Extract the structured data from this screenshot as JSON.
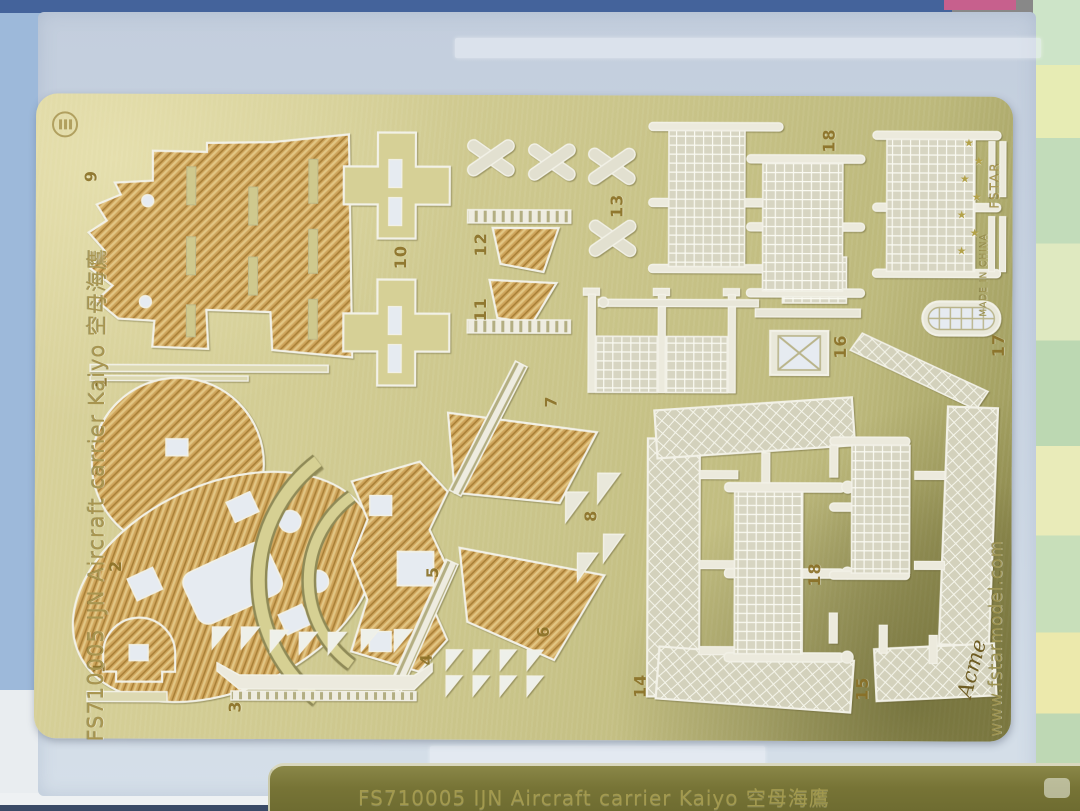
{
  "fret": {
    "title_text": "FS710005 IJN Aircraft carrier Kaiyo 空母海鷹",
    "brand_url": "www.fstarmodel.com",
    "made_in": "MADE IN CHINA",
    "brand": "FSTAR",
    "star": "★",
    "signature": "Acme",
    "part_labels": [
      "9",
      "1",
      "10",
      "12",
      "11",
      "13",
      "18",
      "16",
      "17",
      "7",
      "8",
      "5",
      "2",
      "6",
      "1",
      "3",
      "4",
      "14",
      "18",
      "15"
    ],
    "colors": {
      "brass_base": "#c9c489",
      "brass_dark_corner": "#8f8b4e",
      "deck_hatch": "#cfa55c",
      "etch_white": "#f2f1e7",
      "cutout_paper": "#e6ebf1",
      "number_etch": "#8a7026",
      "backing_paper": "#c9d4e2",
      "fabric_blue": "#9db9da",
      "fabric_green": "#c2dcba",
      "fabric_yellow": "#e7ecb4"
    },
    "icons": {
      "stamp": "circled-manufacturer-stamp"
    }
  },
  "second_fret": {
    "title_text": "FS710005 IJN Aircraft carrier Kaiyo 空母海鷹"
  }
}
